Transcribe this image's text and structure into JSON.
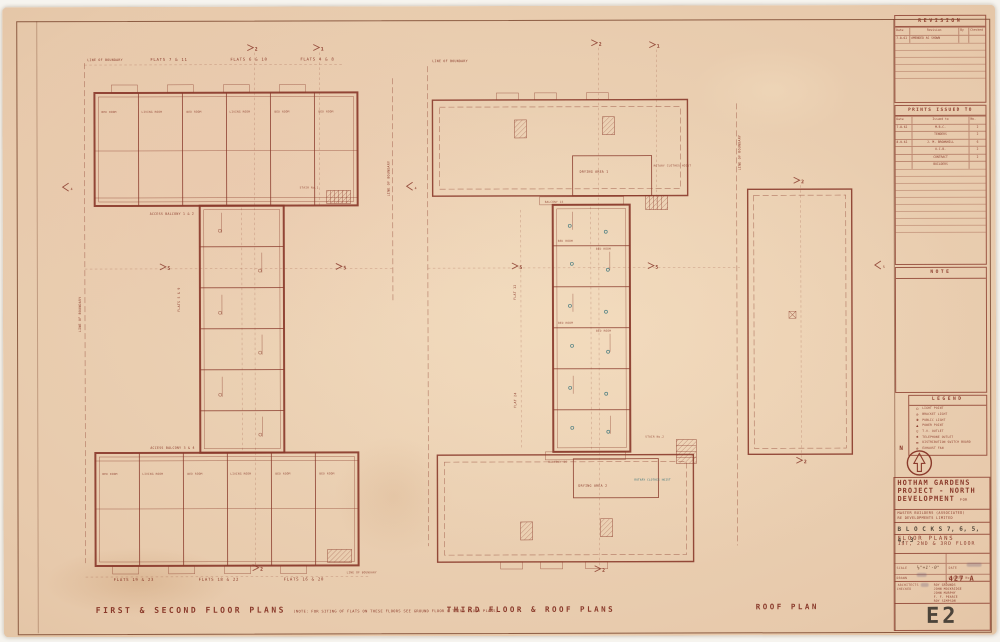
{
  "captions": {
    "left": "FIRST & SECOND FLOOR PLANS",
    "left_note": "(NOTE: FOR SITING OF FLATS ON THESE FLOORS SEE GROUND FLOOR & THIRD FLOOR PLANS)",
    "middle": "THIRD FLOOR & ROOF PLANS",
    "right": "ROOF PLAN"
  },
  "left_plan": {
    "boundary": "LINE OF BOUNDARY",
    "flats_top": [
      "FLATS 7 & 11",
      "FLATS 6 & 10",
      "FLATS 4 & 8"
    ],
    "flats_bottom": [
      "FLATS 19 & 23",
      "FLATS 18 & 22",
      "FLATS 16 & 20"
    ],
    "flats_spine": "FLATS 5 & 9",
    "access_top": "ACCESS BALCONY 1 & 2",
    "access_bottom": "ACCESS BALCONY 3 & 4",
    "stair": "STAIR No.1",
    "rooms": [
      "BED ROOM",
      "LIVING ROOM",
      "BED ROOM",
      "LIVING ROOM",
      "BED ROOM",
      "BED ROOM"
    ]
  },
  "middle_plan": {
    "boundary": "LINE OF BOUNDARY",
    "drying_1": "DRYING AREA 1",
    "drying_2": "DRYING AREA 2",
    "balcony_top": "BALCONY 15",
    "balcony_bottom": "BALCONY 26",
    "flat_upper": "FLAT 12",
    "flat_lower": "FLAT 24",
    "stair": "STAIR No.2",
    "note_1": "ROTARY CLOTHES HOIST",
    "note_2": "ROTARY CLOTHES HOIST",
    "rooms": [
      "BED ROOM",
      "BED ROOM",
      "BED ROOM",
      "BED ROOM"
    ]
  },
  "markers": {
    "l_a": "2",
    "l_b": "1",
    "l_l5": "5",
    "l_r5": "5",
    "l_bot": "2",
    "m_a": "2",
    "m_b": "1",
    "m_l5": "5",
    "m_r5": "5",
    "m_bot": "2",
    "r_top": "2",
    "r_bot": "2",
    "flag_a": "4",
    "flag_b": "4",
    "flag_c": "5"
  },
  "revision": {
    "title": "REVISION",
    "columns": [
      "Date",
      "Revision",
      "By",
      "Checked"
    ],
    "rows": [
      [
        "7.8.61",
        "AMENDED AS SHOWN",
        "",
        ""
      ]
    ]
  },
  "prints": {
    "title": "PRINTS ISSUED TO",
    "columns": [
      "Date",
      "Issued to",
      "No."
    ],
    "rows": [
      [
        "7.8.61",
        "M.B.C.",
        "2"
      ],
      [
        "",
        "TENDERS",
        "2"
      ],
      [
        "8.9.61",
        "J. M. BROWNHILL",
        "6"
      ],
      [
        "",
        "A.C.B.",
        "2"
      ],
      [
        "",
        "CONTRACT",
        "2"
      ],
      [
        "",
        "BUILDERS",
        ""
      ]
    ]
  },
  "note_box": {
    "title": "NOTE"
  },
  "legend": {
    "title": "LEGEND",
    "items": [
      {
        "symbol": "○",
        "label": "LIGHT POINT"
      },
      {
        "symbol": "⊙",
        "label": "BRACKET LIGHT"
      },
      {
        "symbol": "◑",
        "label": "PUBLIC LIGHT"
      },
      {
        "symbol": "▲",
        "label": "POWER POINT"
      },
      {
        "symbol": "▽",
        "label": "T.V. OUTLET"
      },
      {
        "symbol": "✱",
        "label": "TELEPHONE OUTLET"
      },
      {
        "symbol": "▬",
        "label": "DISTRIBUTION SWITCH BOARD"
      },
      {
        "symbol": "⊗",
        "label": "EXHAUST FAN"
      }
    ]
  },
  "compass": {
    "label": "N"
  },
  "title_block": {
    "project_1": "HOTHAM GARDENS",
    "project_2": "PROJECT - NORTH",
    "project_3": "DEVELOPMENT",
    "for_word": "FOR",
    "client_1": "MASTER BUILDERS (ASSOCIATED)",
    "client_2": "RE DEVELOPMENTS LIMITED",
    "blocks": "B L O C K S 7, 6, 5, 4, 3",
    "subtitle_1": "FLOOR PLANS",
    "subtitle_2": "1ST, 2ND & 3RD FLOOR",
    "scale_label": "SCALE",
    "scale_value": "⅛\"=1'-0\"",
    "date_label": "DATE",
    "drawn_label": "DRAWN",
    "checked_label": "CHECKED",
    "drawing_no_label": "DRAWING No.",
    "drawing_no": "427 A",
    "architects_label": "ARCHITECTS",
    "architects": [
      "ROY GROUNDS",
      "JOHN MOCKRIDGE",
      "JOHN MURPHY",
      "F. F. PEARCE",
      "ROY SIMPSON"
    ],
    "sheet_no": "E2"
  }
}
